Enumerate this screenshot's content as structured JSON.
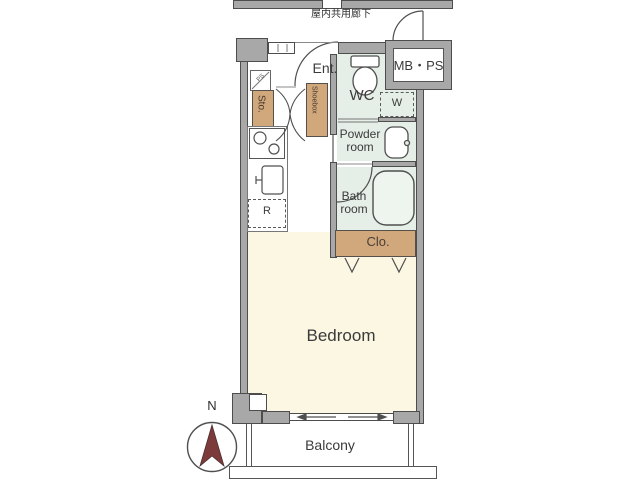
{
  "corridor": {
    "label": "屋内共用廊下"
  },
  "unit": {
    "entrance": {
      "label": "Ent."
    },
    "storage": {
      "label": "Sto."
    },
    "shoebox": {
      "label": "Shoebox"
    },
    "pipe_space": {
      "label": "PS"
    },
    "wc": {
      "label": "WC"
    },
    "meter_box": {
      "label": "MB・PS"
    },
    "washer": {
      "label": "W"
    },
    "powder_room": {
      "label": "Powder room",
      "line1": "Powder",
      "line2": "room"
    },
    "bath_room": {
      "label": "Bath room",
      "line1": "Bath",
      "line2": "room"
    },
    "closet": {
      "label": "Clo."
    },
    "refrigerator": {
      "label": "R"
    },
    "bedroom": {
      "label": "Bedroom"
    },
    "balcony": {
      "label": "Balcony"
    }
  },
  "compass": {
    "label": "N",
    "needle_color": "#7d3a3a"
  },
  "colors": {
    "wall": "#a8a8a8",
    "outline": "#4d4d4d",
    "bedroom_fill": "#fbf7e2",
    "wet_area_fill": "#e5eee7",
    "closet_tan": "#d1a77c",
    "bathtub_fill": "#eef5ee"
  }
}
